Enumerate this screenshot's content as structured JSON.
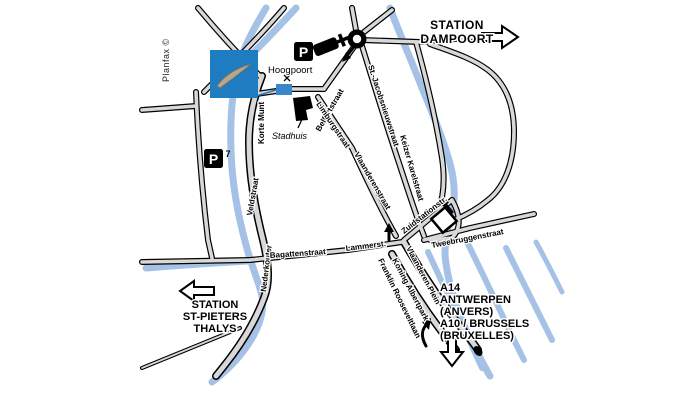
{
  "map": {
    "credit": "Planfax ©",
    "poi": {
      "hoogpoort": "Hoogpoort",
      "stadhuis": "Stadhuis"
    },
    "streets": {
      "korte_munt": "Korte Munt",
      "veldstraat": "Veldstraat",
      "nederkouter": "Nederkouter",
      "belfortstraat": "Belfortstraat",
      "limburgstraat": "Limburgstraat",
      "st_jacobsnieuwstraat": "St.-Jacobsnieuwstraat",
      "keizer_karelstraat": "Keizer Karelstraat",
      "vlaanderenstraat": "Vlaanderenstraat",
      "bagattenstraat": "Bagattenstraat",
      "lammerstraat": "Lammerst.",
      "zuidstationstraat": "Zuidstationstr.",
      "tweebruggenstraat": "Tweebruggenstraat",
      "vlaanderen_plein": "Vlaanderen Plein",
      "koning_albertpark": "Koning Albertpark",
      "franklin_rooseveltlaan": "Franklin Rooseveltlaan"
    },
    "destinations": {
      "dampoort_line1": "STATION",
      "dampoort_line2": "DAMPOORT",
      "stpieters_line1": "STATION",
      "stpieters_line2": "ST-PIETERS",
      "stpieters_line3": "THALYS",
      "highway_line1": "A14",
      "highway_line2": "ANTWERPEN",
      "highway_line3": "(ANVERS)",
      "highway_line4": "A10 / BRUSSELS",
      "highway_line5": "(BRUXELLES)"
    },
    "parking": {
      "p_label": "P",
      "p1_number": "1",
      "p7_number": "7"
    },
    "colors": {
      "water": "#a5c2e6",
      "road_fill": "#d8d8d8",
      "road_casing": "#000000",
      "logo_blue": "#1f7cc0",
      "logo_swoosh": "#b5a68c",
      "highlight_blue": "#3b86c8"
    }
  }
}
